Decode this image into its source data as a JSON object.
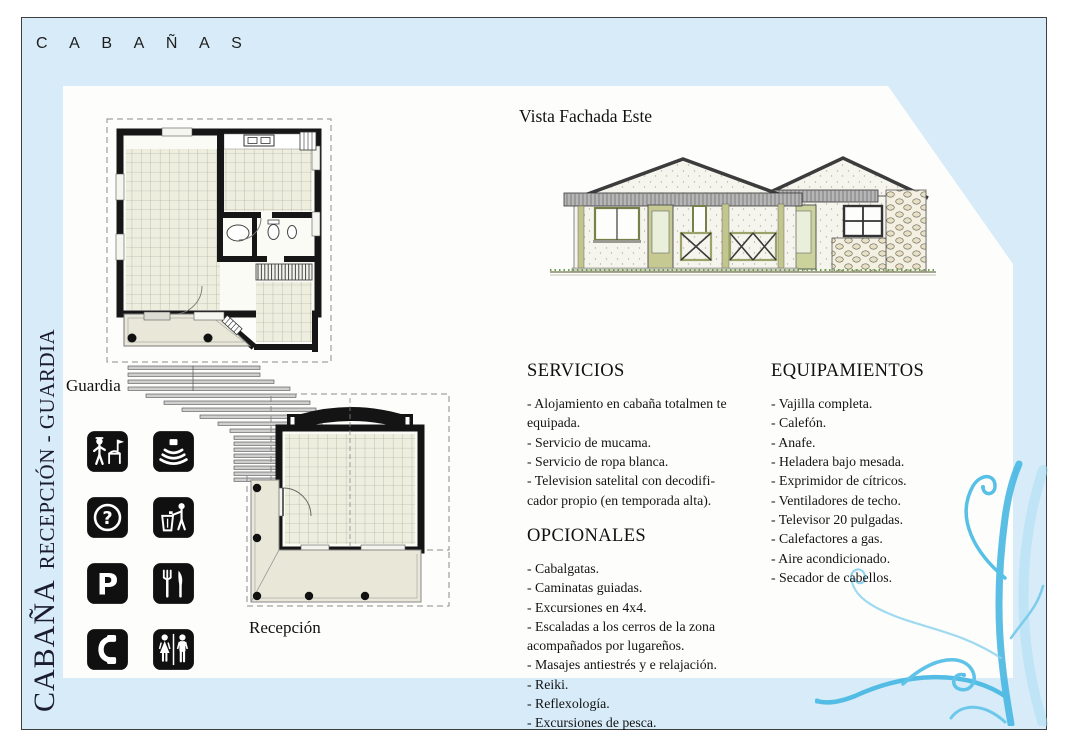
{
  "title": "C A B A Ñ A S",
  "side_label": {
    "main": "CABAÑA",
    "sub": "RECEPCIÓN - GUARDIA"
  },
  "facade": {
    "caption": "Vista Fachada Este"
  },
  "plans": {
    "guardia": "Guardia",
    "recepcion": "Recepción"
  },
  "sections": {
    "servicios": {
      "heading": "SERVICIOS",
      "items": [
        "- Alojamiento en cabaña totalmen te equipada.",
        "- Servicio de mucama.",
        "- Servicio de ropa blanca.",
        "- Television satelital con decodifi-cador propio (en temporada alta)."
      ]
    },
    "opcionales": {
      "heading": "OPCIONALES",
      "items": [
        "- Cabalgatas.",
        "- Caminatas guiadas.",
        "- Excursiones en 4x4.",
        "- Escaladas a los cerros de la zona acompañados por lugareños.",
        "- Masajes antiestrés y e relajación.",
        "- Reiki.",
        "- Reflexología.",
        "- Excursiones de pesca."
      ]
    },
    "equipamientos": {
      "heading": "EQUIPAMIENTOS",
      "items": [
        "- Vajilla completa.",
        "- Calefón.",
        "- Anafe.",
        "- Heladera bajo mesada.",
        "- Exprimidor de cítricos.",
        "- Ventiladores de techo.",
        "- Televisor 20 pulgadas.",
        "- Calefactores a gas.",
        "- Aire acondicionado.",
        "- Secador de cabellos."
      ]
    }
  },
  "icons": {
    "question_glyph": "?",
    "parking_glyph": "P",
    "names": [
      "guard-station",
      "sound-waves",
      "information",
      "litter-disposal",
      "parking",
      "restaurant",
      "telephone",
      "restrooms"
    ]
  },
  "colors": {
    "page_blue": "#d7ebf8",
    "accent_blue": "#57c0e6",
    "olive_trim": "#b8bc7e",
    "wall_black": "#161616",
    "tile_fill": "#eeeede"
  }
}
